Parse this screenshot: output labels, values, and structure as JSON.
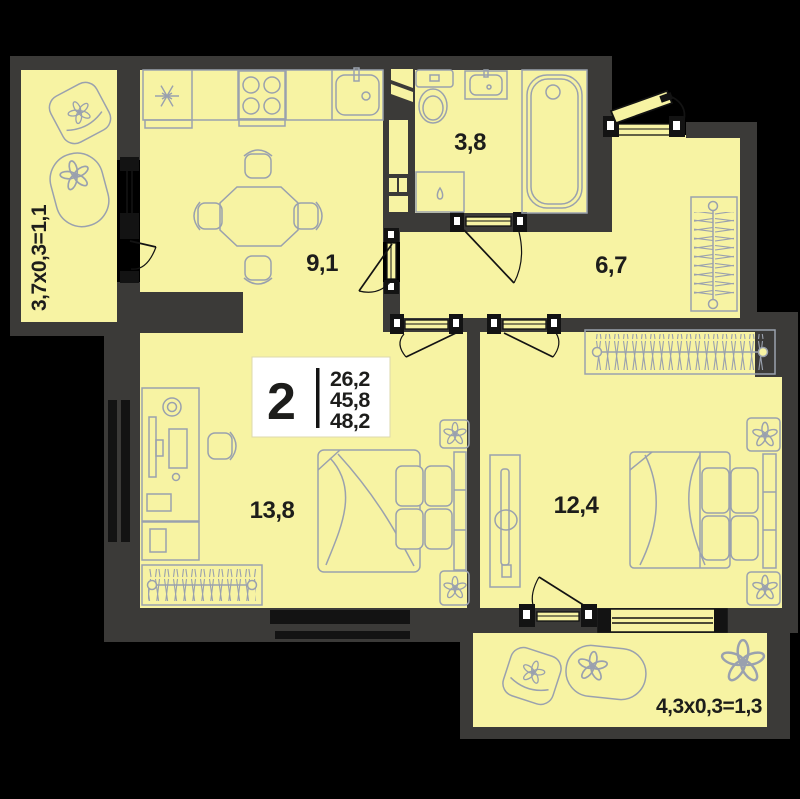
{
  "floor_plan": {
    "unit_card": {
      "rooms": "2",
      "area_values": [
        "26,2",
        "45,8",
        "48,2"
      ]
    },
    "room_labels": {
      "kitchen": "9,1",
      "bathroom": "3,8",
      "hallway": "6,7",
      "bedroom_left": "13,8",
      "bedroom_right": "12,4",
      "balcony_left": "3,7x0,3=1,1",
      "balcony_bottom": "4,3x0,3=1,3"
    },
    "colors": {
      "background": "#000000",
      "walls": "#3b3a38",
      "floor": "#f7f3a3",
      "furniture_stroke": "#9aa1ae",
      "detail": "#131313",
      "card_bg": "#ffffff",
      "text": "#1d1d1b"
    }
  }
}
